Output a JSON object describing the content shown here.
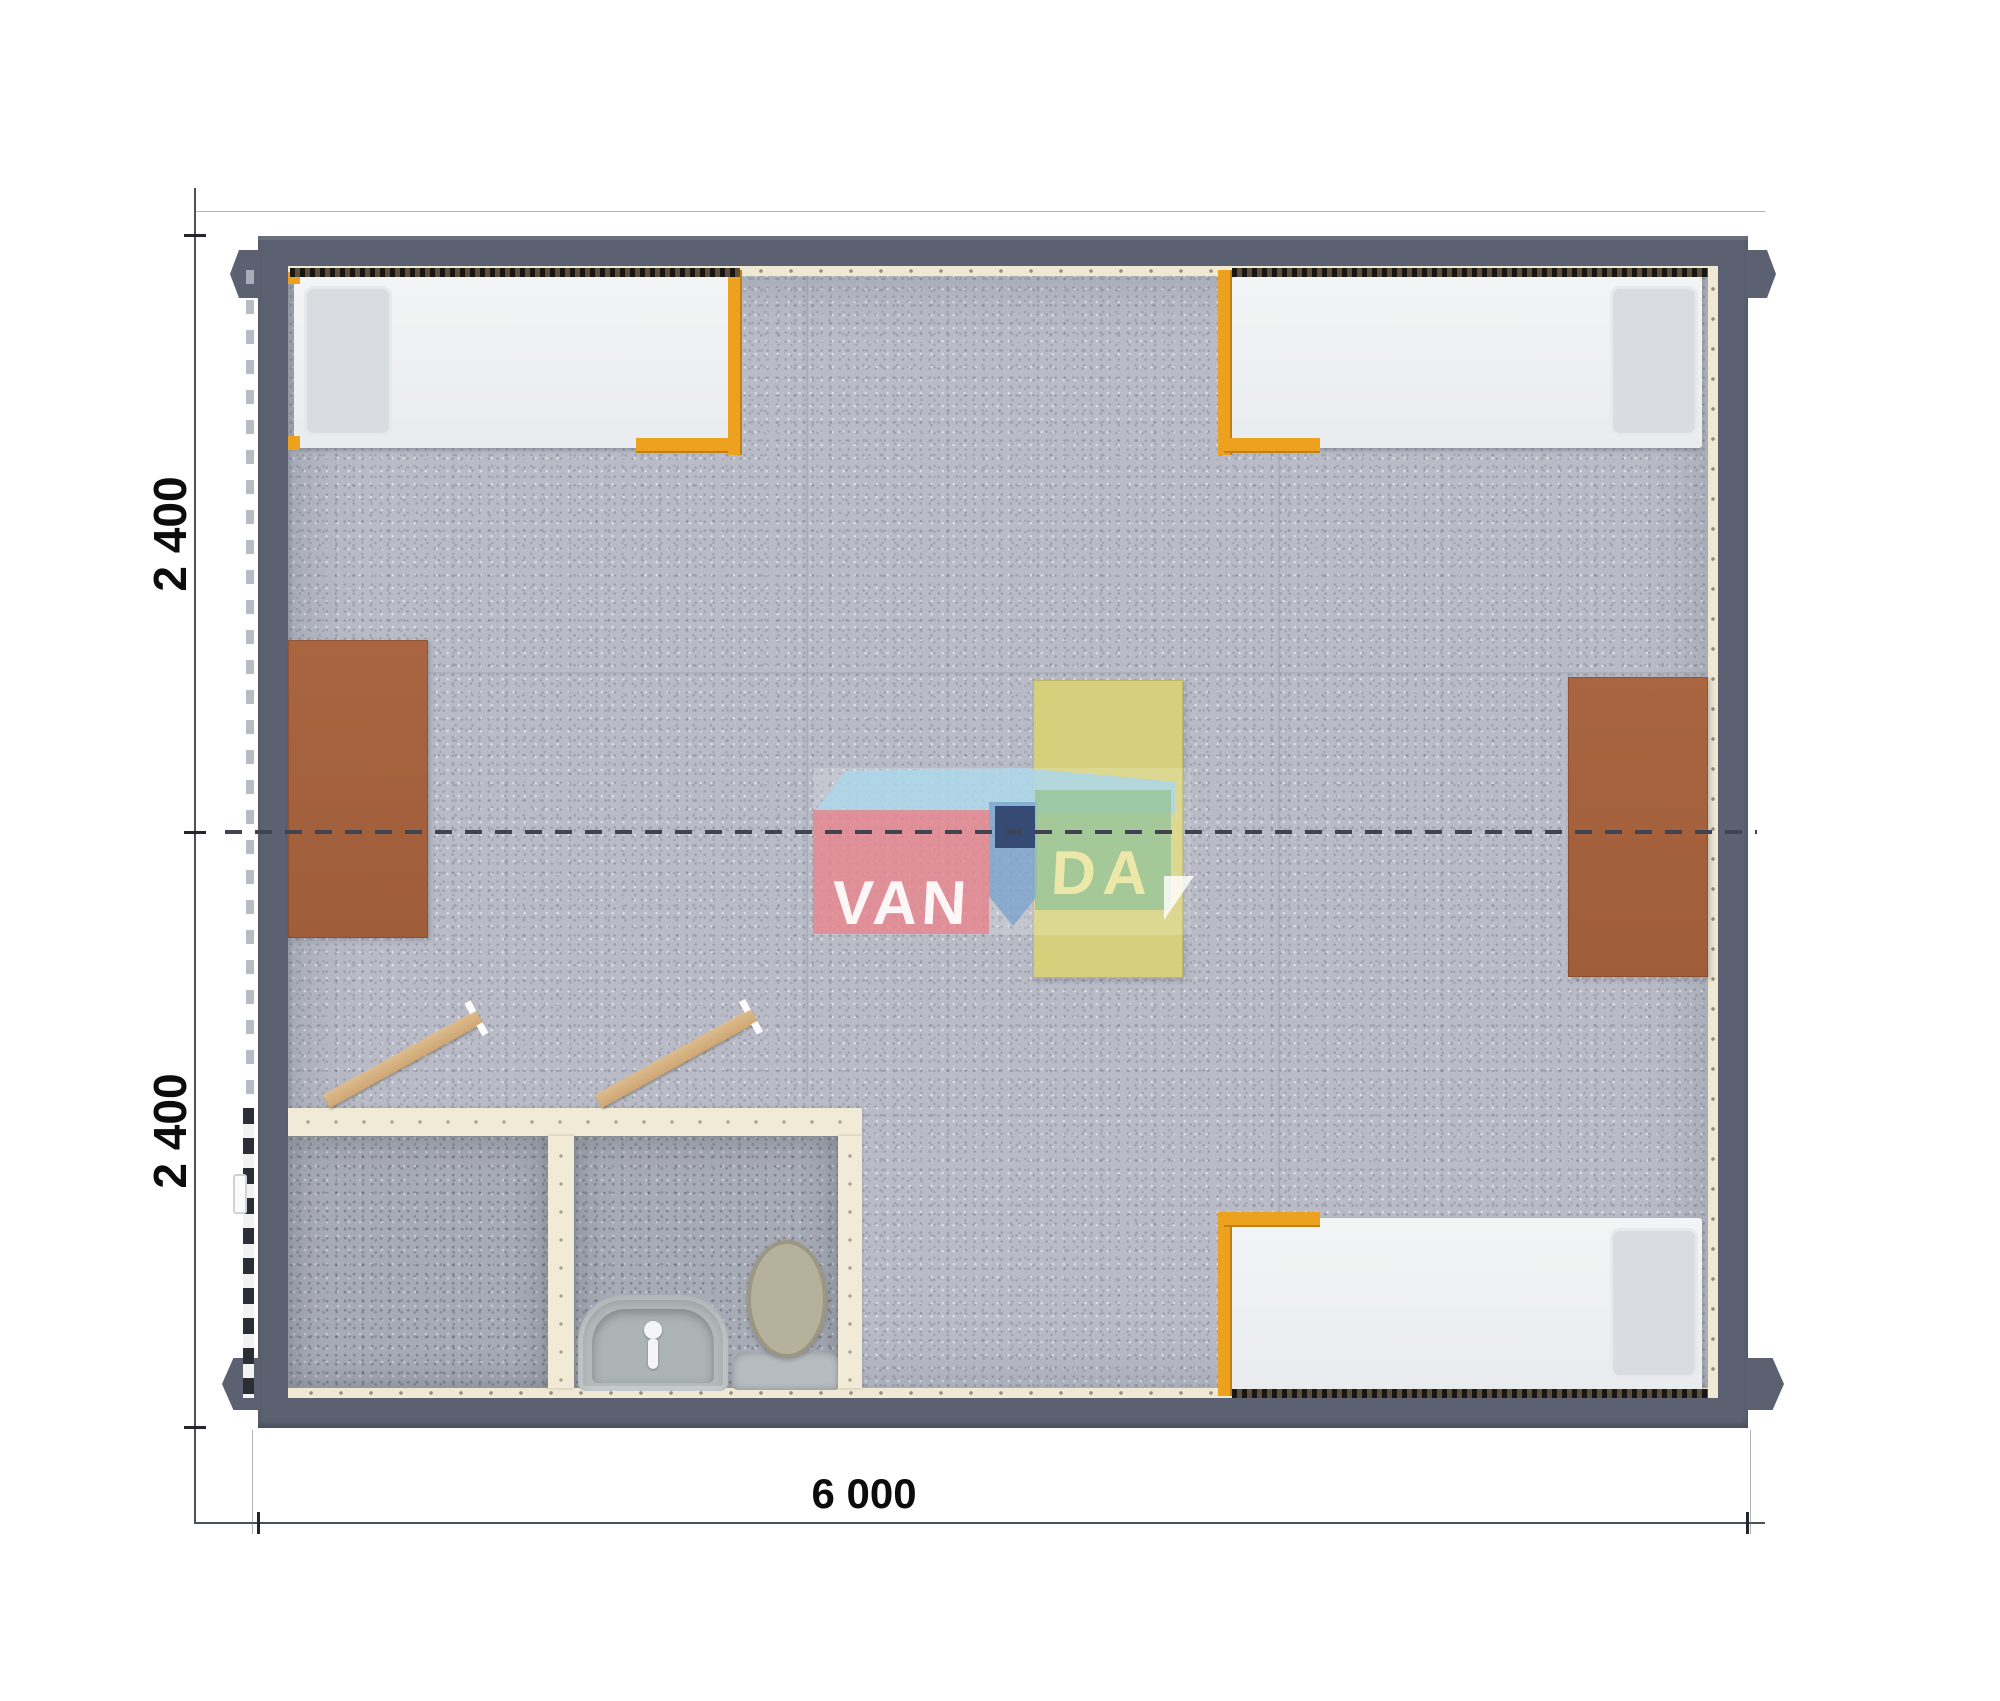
{
  "title": "Modular cabin floor plan - top view render",
  "dimensions": {
    "left_top_label": "2 400",
    "left_bottom_label": "2 400",
    "bottom_label": "6 000"
  },
  "logo": {
    "name": "VANDA",
    "text_left": "VAN",
    "text_right": "DA"
  },
  "colors": {
    "background": "#ffffff",
    "wall": "#5b6170",
    "floor_carpet": "#b9bcc7",
    "bathroom_floor": "#a7abb5",
    "wall_lining": "#efe8d2",
    "partition": "#f0ead6",
    "bed_mattress": "#eff1f4",
    "bed_pillow": "#d9dde1",
    "bed_frame_orange": "#eca11f",
    "desk_brown": "#a5613c",
    "table_yellow": "#d6d07d",
    "door_wood": "#d7b182",
    "toilet_lid": "#b6b19b",
    "sink_gray": "#b6bcbe",
    "center_dash_line": "#3f4450",
    "dimension_text": "#0c0c0c",
    "logo_red": "#e7828a",
    "logo_roof_blue": "#abd7ea",
    "logo_navy": "#2a3e68",
    "logo_green": "#96c498"
  },
  "furniture": {
    "beds": [
      {
        "id": "bed-top-left",
        "pillow_side": "left"
      },
      {
        "id": "bed-top-right",
        "pillow_side": "right"
      },
      {
        "id": "bed-bottom-right",
        "pillow_side": "right"
      }
    ],
    "tables": [
      {
        "id": "desk-left"
      },
      {
        "id": "desk-right"
      },
      {
        "id": "table-center"
      }
    ],
    "bathroom": {
      "rooms": 2,
      "fixtures": [
        "sink",
        "toilet"
      ],
      "open_doors": 2
    }
  }
}
